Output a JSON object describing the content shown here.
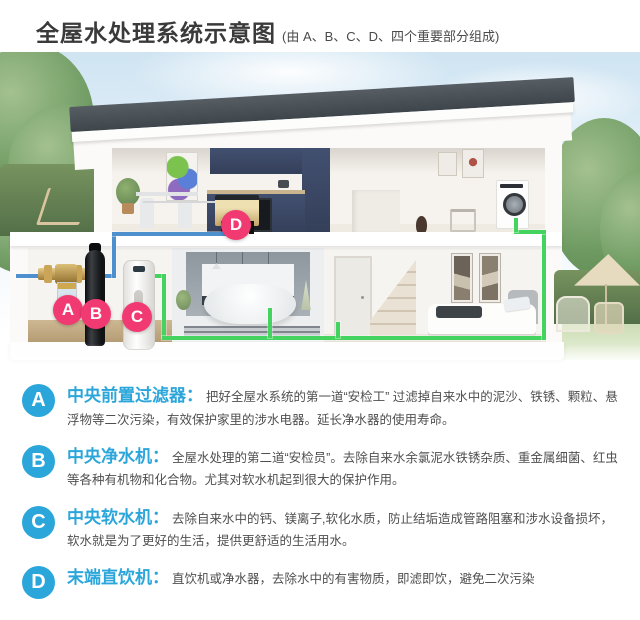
{
  "header": {
    "title": "全屋水处理系统示意图",
    "subtitle": "(由 A、B、C、D、四个重要部分组成)"
  },
  "diagram": {
    "badges": [
      "A",
      "B",
      "C",
      "D"
    ],
    "badge_color": "#f23a72",
    "cold_water_pipe_color": "#4e8fce",
    "treated_water_pipe_color": "#45d35f"
  },
  "legend": {
    "badge_color": "#2ba6db",
    "items": [
      {
        "id": "A",
        "title": "中央前置过滤器：",
        "desc": "把好全屋水系统的第一道“安检工” 过滤掉自来水中的泥沙、铁锈、颗粒、悬浮物等二次污染，有效保护家里的涉水电器。延长净水器的使用寿命。"
      },
      {
        "id": "B",
        "title": "中央净水机：",
        "desc": "全屋水处理的第二道“安检员”。去除自来水余氯泥水铁锈杂质、重金属细菌、红虫等各种有机物和化合物。尤其对软水机起到很大的保护作用。"
      },
      {
        "id": "C",
        "title": "中央软水机：",
        "desc": "去除自来水中的钙、镁离子,软化水质，防止结垢造成管路阻塞和涉水设备损坏，软水就是为了更好的生活，提供更舒适的生活用水。"
      },
      {
        "id": "D",
        "title": "末端直饮机：",
        "desc": "直饮机或净水器，去除水中的有害物质，即滤即饮，避免二次污染"
      }
    ]
  }
}
